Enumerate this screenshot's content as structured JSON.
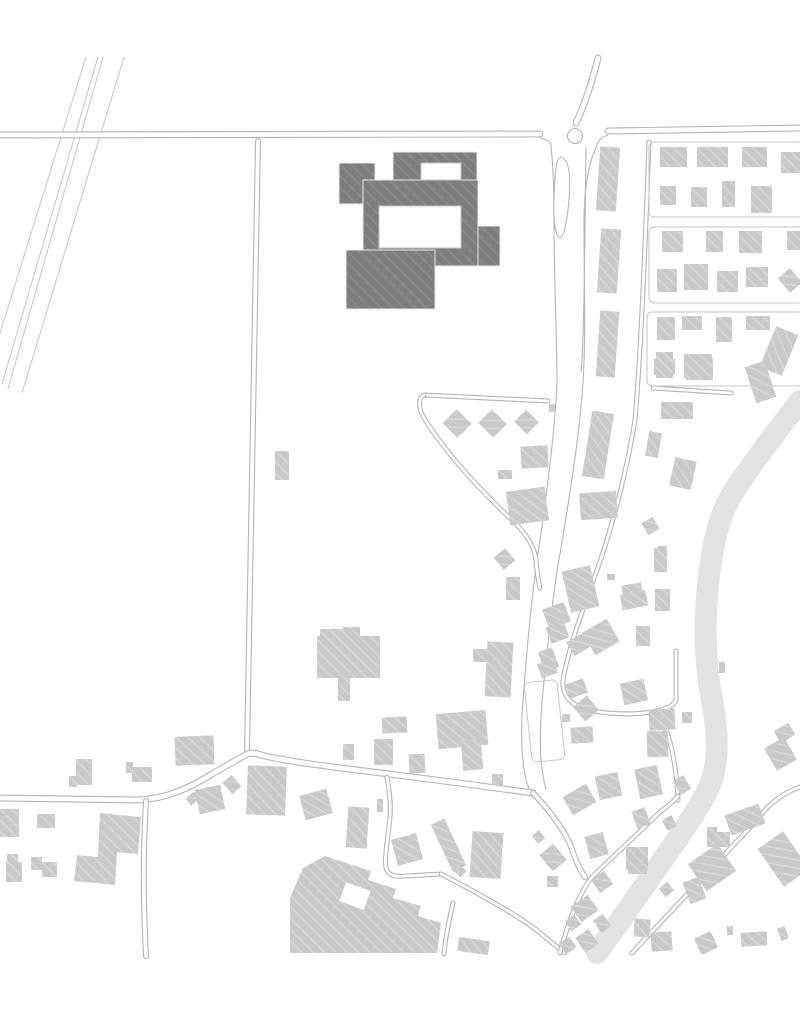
{
  "map": {
    "canvas": {
      "width": 800,
      "height": 1015,
      "background": "#ffffff"
    },
    "palette": {
      "road_line": "#b4b4b4",
      "road_fill": "#ffffff",
      "outline": "#c6c6c6",
      "rail_line": "#c4c4c4",
      "band": "#e3e3e3",
      "building_light": "#c9c9c9",
      "building_light_hatch": "rgba(255,255,255,0.30)",
      "building_dark": "#7e7e7e",
      "building_dark_hatch": "rgba(255,255,255,0.10)",
      "building_dark_seam": "#eaeaea",
      "courtyard": "#ffffff",
      "courtyard_line": "#c4c4c4"
    },
    "band": {
      "d": "M800,401 C770,440 745,473 731,496 C719,516 712,545 708,585 C704,625 705,665 712,700 C718,733 719,760 711,782 C704,800 693,816 678,838 C660,864 636,898 617,925 C607,939 601,947 597,953",
      "width": 22
    },
    "rails": [
      [
        86,
        57,
        0,
        333
      ],
      [
        98,
        57,
        2,
        384
      ],
      [
        103,
        57,
        8,
        389
      ],
      [
        124,
        57,
        22,
        393
      ]
    ],
    "corridor_edges": [
      "M551,146 C553,165 554,185 554,215 C554,285 557,335 557,382 C555,432 546,500 537,560 C531,602 527,650 523,700 C520,740 522,770 529,789",
      "M596,148 C589,162 585,185 584,215 C584,285 586,335 583,382 C580,432 569,502 558,565 C551,610 546,660 542,702 C539,745 540,768 546,789",
      "M586,148 C585,200 585,250 584,300 C583,330 583,352 581,372",
      "M540,138 C550,140 551,143 551,146",
      "M608,135 C600,138 597,142 596,148"
    ],
    "roads": [
      {
        "name": "main-road-west",
        "d": "M0,135 L540,134",
        "w": 7
      },
      {
        "name": "main-road-east",
        "d": "M608,131 L800,128",
        "w": 7
      },
      {
        "name": "north-stub",
        "d": "M598,58 C590,90 583,108 576,123",
        "w": 7
      },
      {
        "name": "field-lane",
        "d": "M258,141 C255,300 251,520 247,752",
        "w": 6
      },
      {
        "name": "village-road",
        "d": "M0,798 L138,800 C165,799 188,789 212,774 L247,754 C252,752 258,754 265,756 C300,764 360,770 420,778 C460,783 505,789 533,793",
        "w": 7
      },
      {
        "name": "south-lane",
        "d": "M146,801 C143,850 143,900 146,956",
        "w": 6
      },
      {
        "name": "grid-lane",
        "d": "M649,142 C645,250 641,350 635,420 C629,458 615,520 597,570 C584,606 567,652 563,681 C562,700 576,709 600,712 C622,715 642,714 657,711",
        "w": 5
      },
      {
        "name": "east-lane",
        "d": "M653,388 L731,393",
        "w": 5
      },
      {
        "name": "culdesac-lane",
        "d": "M657,711 C668,727 674,755 677,783 L678,800",
        "w": 5
      },
      {
        "name": "culdesac-north",
        "d": "M656,711 C668,708 674,706 676,700 L676,651",
        "w": 5
      },
      {
        "name": "loop-top",
        "d": "M424,395 L548,401",
        "w": 5
      },
      {
        "name": "loop",
        "d": "M424,395 C418,398 418,408 424,418 C445,452 480,490 515,523 C528,536 535,549 536,560 C537,572 538,580 540,588",
        "w": 5
      },
      {
        "name": "sw-branch",
        "d": "M387,777 C390,795 391,806 390,817 C388,838 384,860 386,868 C388,876 396,877 406,876 L441,874",
        "w": 5
      },
      {
        "name": "s-branch",
        "d": "M441,874 C470,889 515,913 539,932 C548,940 557,947 565,953",
        "w": 5
      },
      {
        "name": "s-branch-2",
        "d": "M453,903 C448,925 445,940 444,954",
        "w": 5
      },
      {
        "name": "se-road",
        "d": "M533,793 C552,813 564,831 570,844 C573,852 578,868 585,877",
        "w": 6
      },
      {
        "name": "se-street-a",
        "d": "M560,953 C570,915 581,891 592,877 L660,812 C668,806 674,801 678,796",
        "w": 5
      },
      {
        "name": "se-street-b",
        "d": "M632,953 L757,820 C765,808 780,794 800,787",
        "w": 5
      }
    ],
    "blocks": [
      {
        "x": 649,
        "y": 142,
        "w": 154,
        "h": 75,
        "a": 0
      },
      {
        "x": 649,
        "y": 227,
        "w": 154,
        "h": 76,
        "a": 0
      },
      {
        "x": 647,
        "y": 312,
        "w": 156,
        "h": 74,
        "a": 0
      },
      {
        "x": 528,
        "y": 681,
        "w": 33,
        "h": 80,
        "a": -6
      }
    ],
    "roundabout": {
      "cx": 575,
      "cy": 136,
      "r": 7.5
    },
    "island": {
      "d": "M561,157 C569,159 571,175 569,200 C567,222 564,236 560,238 C556,237 553,224 554,198 C555,172 556,158 561,157"
    },
    "buildings_light": [
      [
        598,
        147,
        20,
        64,
        4
      ],
      [
        599,
        229,
        20,
        64,
        4
      ],
      [
        598,
        311,
        19,
        66,
        4
      ],
      [
        660,
        147,
        27,
        20,
        0
      ],
      [
        697,
        147,
        31,
        20,
        0
      ],
      [
        742,
        147,
        25,
        20,
        0
      ],
      [
        781,
        152,
        19,
        21,
        0
      ],
      [
        660,
        186,
        16,
        19,
        0
      ],
      [
        691,
        187,
        16,
        20,
        0
      ],
      [
        722,
        181,
        13,
        26,
        0
      ],
      [
        751,
        186,
        21,
        27,
        0
      ],
      [
        662,
        231,
        21,
        21,
        0
      ],
      [
        706,
        231,
        17,
        21,
        0
      ],
      [
        739,
        231,
        23,
        22,
        0
      ],
      [
        787,
        231,
        13,
        19,
        0
      ],
      [
        657,
        269,
        20,
        23,
        0
      ],
      [
        684,
        264,
        24,
        26,
        0
      ],
      [
        717,
        271,
        21,
        21,
        0
      ],
      [
        746,
        267,
        22,
        20,
        0
      ],
      [
        782,
        271,
        16,
        19,
        -40
      ],
      [
        657,
        317,
        18,
        23,
        0
      ],
      [
        682,
        316,
        20,
        14,
        0
      ],
      [
        716,
        317,
        16,
        25,
        0
      ],
      [
        746,
        316,
        24,
        14,
        0
      ],
      [
        767,
        329,
        24,
        44,
        22
      ],
      [
        656,
        352,
        17,
        26,
        0
      ],
      [
        684,
        354,
        28,
        24,
        0
      ],
      [
        750,
        363,
        21,
        38,
        -18
      ],
      [
        447,
        413,
        20,
        21,
        -45
      ],
      [
        483,
        413,
        19,
        21,
        -45
      ],
      [
        518,
        413,
        17,
        18,
        -45
      ],
      [
        549,
        404,
        6,
        8,
        0
      ],
      [
        521,
        446,
        27,
        22,
        -3
      ],
      [
        498,
        470,
        14,
        9,
        0
      ],
      [
        508,
        489,
        39,
        34,
        -8
      ],
      [
        497,
        551,
        15,
        16,
        -40
      ],
      [
        506,
        577,
        14,
        23,
        0
      ],
      [
        587,
        412,
        22,
        66,
        9
      ],
      [
        580,
        492,
        37,
        27,
        -4
      ],
      [
        661,
        402,
        32,
        17,
        0
      ],
      [
        647,
        432,
        13,
        25,
        10
      ],
      [
        672,
        459,
        22,
        29,
        12
      ],
      [
        644,
        519,
        13,
        14,
        -30
      ],
      [
        654,
        359,
        21,
        16,
        0
      ],
      [
        686,
        359,
        27,
        21,
        0
      ],
      [
        719,
        662,
        6,
        11,
        0
      ],
      [
        275,
        451,
        14,
        29,
        0
      ],
      [
        317,
        636,
        63,
        42,
        0
      ],
      [
        320,
        629,
        24,
        8,
        0
      ],
      [
        343,
        627,
        17,
        9,
        0
      ],
      [
        338,
        678,
        12,
        23,
        0
      ],
      [
        486,
        642,
        26,
        55,
        3
      ],
      [
        473,
        649,
        14,
        13,
        0
      ],
      [
        437,
        712,
        50,
        35,
        -5
      ],
      [
        462,
        740,
        20,
        30,
        -5
      ],
      [
        382,
        717,
        25,
        16,
        -3
      ],
      [
        343,
        744,
        11,
        16,
        0
      ],
      [
        374,
        739,
        19,
        26,
        0
      ],
      [
        409,
        754,
        16,
        19,
        -3
      ],
      [
        492,
        774,
        11,
        11,
        0
      ],
      [
        566,
        568,
        29,
        42,
        -13
      ],
      [
        607,
        574,
        8,
        6,
        0
      ],
      [
        622,
        584,
        20,
        10,
        -10
      ],
      [
        621,
        592,
        26,
        16,
        -12
      ],
      [
        545,
        605,
        23,
        21,
        -20
      ],
      [
        548,
        624,
        19,
        17,
        -20
      ],
      [
        541,
        649,
        15,
        21,
        -20
      ],
      [
        539,
        661,
        17,
        15,
        -20
      ],
      [
        654,
        548,
        13,
        24,
        0
      ],
      [
        658,
        546,
        9,
        7,
        0
      ],
      [
        655,
        589,
        15,
        22,
        0
      ],
      [
        636,
        626,
        14,
        20,
        0
      ],
      [
        587,
        624,
        28,
        26,
        -30
      ],
      [
        569,
        636,
        21,
        16,
        -30
      ],
      [
        567,
        681,
        19,
        15,
        -20
      ],
      [
        622,
        681,
        24,
        22,
        -12
      ],
      [
        649,
        709,
        26,
        21,
        -3
      ],
      [
        682,
        712,
        10,
        11,
        0
      ],
      [
        647,
        731,
        21,
        26,
        -2
      ],
      [
        637,
        767,
        23,
        30,
        -12
      ],
      [
        676,
        777,
        12,
        16,
        -30
      ],
      [
        577,
        699,
        18,
        19,
        -40
      ],
      [
        562,
        714,
        8,
        8,
        0
      ],
      [
        571,
        727,
        22,
        16,
        -3
      ],
      [
        597,
        774,
        23,
        24,
        -12
      ],
      [
        566,
        789,
        27,
        21,
        -30
      ],
      [
        776,
        726,
        17,
        14,
        -30
      ],
      [
        769,
        741,
        23,
        26,
        -30
      ],
      [
        76,
        759,
        16,
        26,
        0
      ],
      [
        69,
        776,
        8,
        11,
        0
      ],
      [
        126,
        762,
        7,
        11,
        0
      ],
      [
        132,
        767,
        20,
        15,
        0
      ],
      [
        175,
        736,
        39,
        29,
        -2
      ],
      [
        187,
        794,
        11,
        9,
        -40
      ],
      [
        197,
        787,
        26,
        25,
        -12
      ],
      [
        226,
        777,
        12,
        15,
        -40
      ],
      [
        247,
        766,
        39,
        49,
        2
      ],
      [
        0,
        809,
        19,
        28,
        0
      ],
      [
        37,
        814,
        18,
        14,
        0
      ],
      [
        7,
        854,
        11,
        9,
        0
      ],
      [
        6,
        862,
        16,
        20,
        0
      ],
      [
        31,
        857,
        11,
        13,
        0
      ],
      [
        42,
        862,
        15,
        15,
        0
      ],
      [
        302,
        792,
        28,
        25,
        -15
      ],
      [
        347,
        807,
        21,
        41,
        4
      ],
      [
        377,
        799,
        6,
        13,
        0
      ],
      [
        394,
        836,
        26,
        27,
        -15
      ],
      [
        441,
        819,
        15,
        52,
        -25
      ],
      [
        454,
        866,
        11,
        9,
        45
      ],
      [
        471,
        832,
        31,
        46,
        4
      ],
      [
        534,
        832,
        9,
        10,
        -40
      ],
      [
        544,
        847,
        18,
        21,
        -40
      ],
      [
        547,
        876,
        11,
        11,
        0
      ],
      [
        458,
        939,
        31,
        14,
        8
      ],
      [
        574,
        899,
        21,
        19,
        -35
      ],
      [
        567,
        917,
        12,
        12,
        -35
      ],
      [
        579,
        932,
        16,
        18,
        -35
      ],
      [
        561,
        939,
        13,
        13,
        -35
      ],
      [
        587,
        834,
        19,
        23,
        -15
      ],
      [
        594,
        874,
        16,
        16,
        -35
      ],
      [
        596,
        916,
        12,
        15,
        -35
      ],
      [
        626,
        847,
        22,
        23,
        0
      ],
      [
        628,
        870,
        19,
        4,
        0
      ],
      [
        634,
        919,
        16,
        18,
        4
      ],
      [
        651,
        932,
        21,
        19,
        -4
      ],
      [
        661,
        884,
        11,
        11,
        -40
      ],
      [
        634,
        809,
        14,
        18,
        -20
      ],
      [
        664,
        817,
        11,
        12,
        -30
      ],
      [
        707,
        827,
        10,
        20,
        0
      ],
      [
        717,
        832,
        13,
        15,
        0
      ],
      [
        694,
        851,
        36,
        33,
        -35
      ],
      [
        686,
        879,
        17,
        23,
        -20
      ],
      [
        697,
        934,
        18,
        18,
        -25
      ],
      [
        727,
        926,
        6,
        9,
        0
      ],
      [
        727,
        809,
        36,
        21,
        -20
      ],
      [
        768,
        836,
        31,
        46,
        -35
      ],
      [
        741,
        932,
        26,
        14,
        -3
      ],
      [
        779,
        927,
        8,
        13,
        -20
      ]
    ],
    "polys_light": [
      [
        [
          100,
          813
        ],
        [
          141,
          817
        ],
        [
          138,
          854
        ],
        [
          117,
          852
        ],
        [
          115,
          885
        ],
        [
          74,
          881
        ],
        [
          77,
          855
        ],
        [
          98,
          857
        ]
      ],
      [
        [
          325,
          856
        ],
        [
          371,
          871
        ],
        [
          368,
          880
        ],
        [
          396,
          889
        ],
        [
          393,
          898
        ],
        [
          421,
          906
        ],
        [
          418,
          916
        ],
        [
          441,
          923
        ],
        [
          437,
          953
        ],
        [
          290,
          953
        ],
        [
          290,
          898
        ],
        [
          303,
          868
        ]
      ]
    ],
    "cutouts_white": [
      [
        342,
        886,
        26,
        20,
        20
      ]
    ],
    "buildings_dark": [
      [
        393,
        152,
        84,
        28,
        0
      ],
      [
        339,
        163,
        36,
        41,
        0
      ],
      [
        363,
        180,
        115,
        86,
        0
      ],
      [
        478,
        226,
        22,
        40,
        0
      ],
      [
        346,
        250,
        89,
        59,
        0
      ]
    ],
    "courtyards": [
      [
        421,
        163,
        40,
        17,
        0
      ],
      [
        379,
        206,
        82,
        42,
        0
      ]
    ]
  }
}
